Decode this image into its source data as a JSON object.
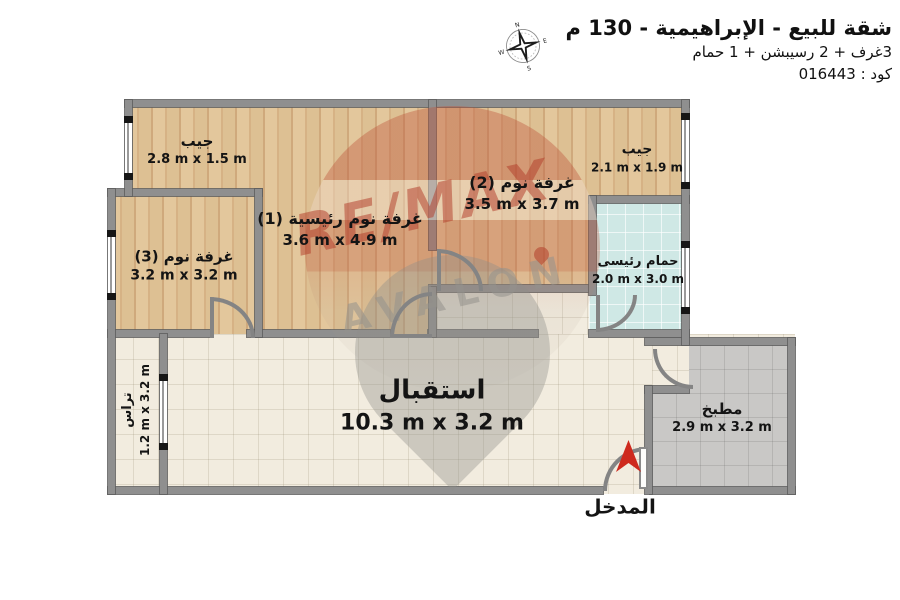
{
  "header": {
    "title": "شقة للبيع - الإبراهيمية - 130 م",
    "subtitle": "3غرف + 2 رسيبشن + 1 حمام",
    "code": "كود : 016443"
  },
  "compass": {
    "points": [
      "N",
      "E",
      "S",
      "W"
    ]
  },
  "watermark": {
    "line1": "RE/MAX",
    "line2": "AVALON"
  },
  "rooms": {
    "jib_tl": {
      "name": "جيب",
      "dims": "2.8 m x 1.5 m"
    },
    "master_bedroom": {
      "name": "غرفة نوم رئيسية (1)",
      "dims": "3.6 m x 4.9 m"
    },
    "bedroom_2": {
      "name": "غرفة نوم (2)",
      "dims": "3.5 m x 3.7 m"
    },
    "jib_tr": {
      "name": "جيب",
      "dims": "2.1 m x 1.9 m"
    },
    "main_bathroom": {
      "name": "حمام رئيسى",
      "dims": "2.0 m x 3.0 m"
    },
    "bedroom_3": {
      "name": "غرفة نوم (3)",
      "dims": "3.2 m x 3.2 m"
    },
    "reception": {
      "name": "استقبال",
      "dims": "10.3 m x 3.2 m"
    },
    "terrace": {
      "name": "تراس",
      "dims": "1.2 m x 3.2 m"
    },
    "kitchen": {
      "name": "مطبخ",
      "dims": "2.9 m x 3.2 m"
    },
    "entrance": {
      "name": "المدخل"
    }
  },
  "colors": {
    "wall": "#8f8f8f",
    "wood_floor": "#dcbd92",
    "tile_cream": "#f2ecdf",
    "tile_blue": "#cfe8e5",
    "tile_gray": "#c9c8c6",
    "entrance_red": "#ce2a1e",
    "watermark_red": "#b23e2a",
    "watermark_gray": "#94918d"
  }
}
